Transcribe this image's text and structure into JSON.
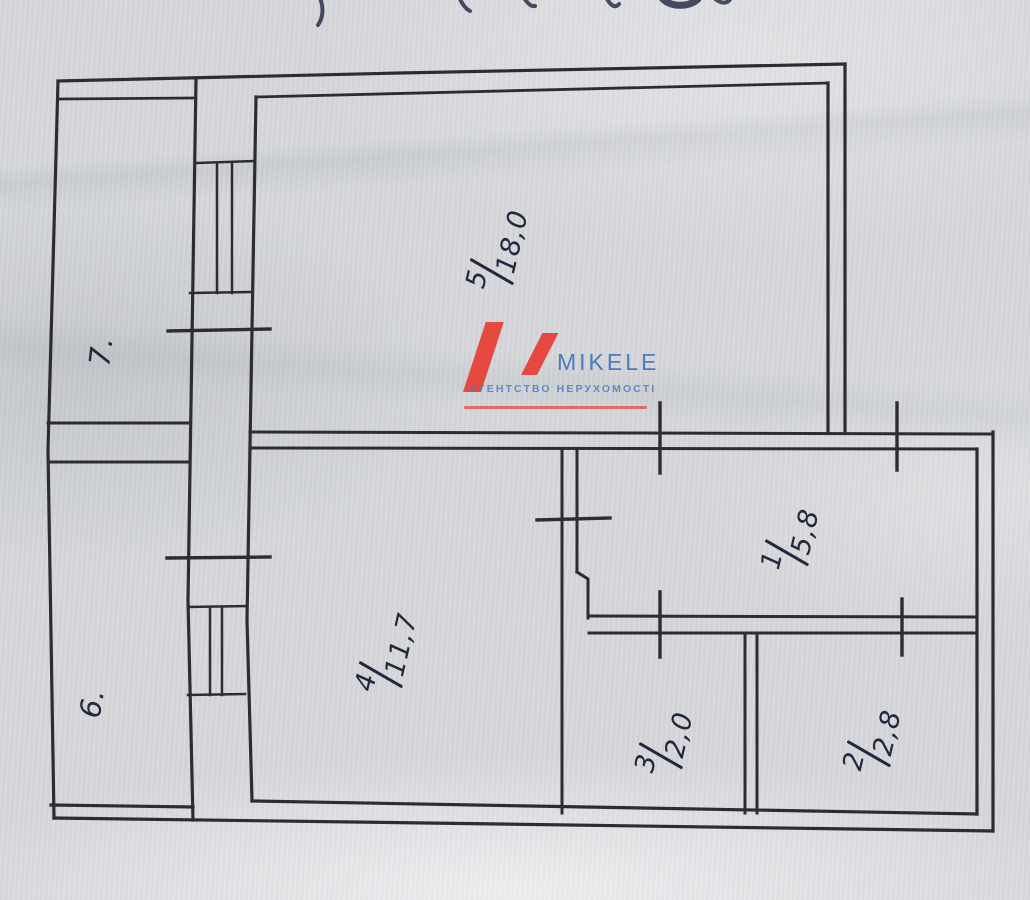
{
  "document": {
    "paper_color": "#d6d8db",
    "ink_color": "#2d2d31",
    "pen_color": "#26263c"
  },
  "logo": {
    "name": "MIKELE",
    "tagline": "АГЕНТСТВО НЕРУХОМОСТІ",
    "brand_blue": "#3a6fbc",
    "brand_red": "#e8362c"
  },
  "rooms": [
    {
      "number": "5",
      "area": "18,0"
    },
    {
      "number": "4",
      "area": "11,7"
    },
    {
      "number": "1",
      "area": "5,8"
    },
    {
      "number": "3",
      "area": "2,0"
    },
    {
      "number": "2",
      "area": "2,8"
    },
    {
      "number": "7."
    },
    {
      "number": "6."
    }
  ]
}
